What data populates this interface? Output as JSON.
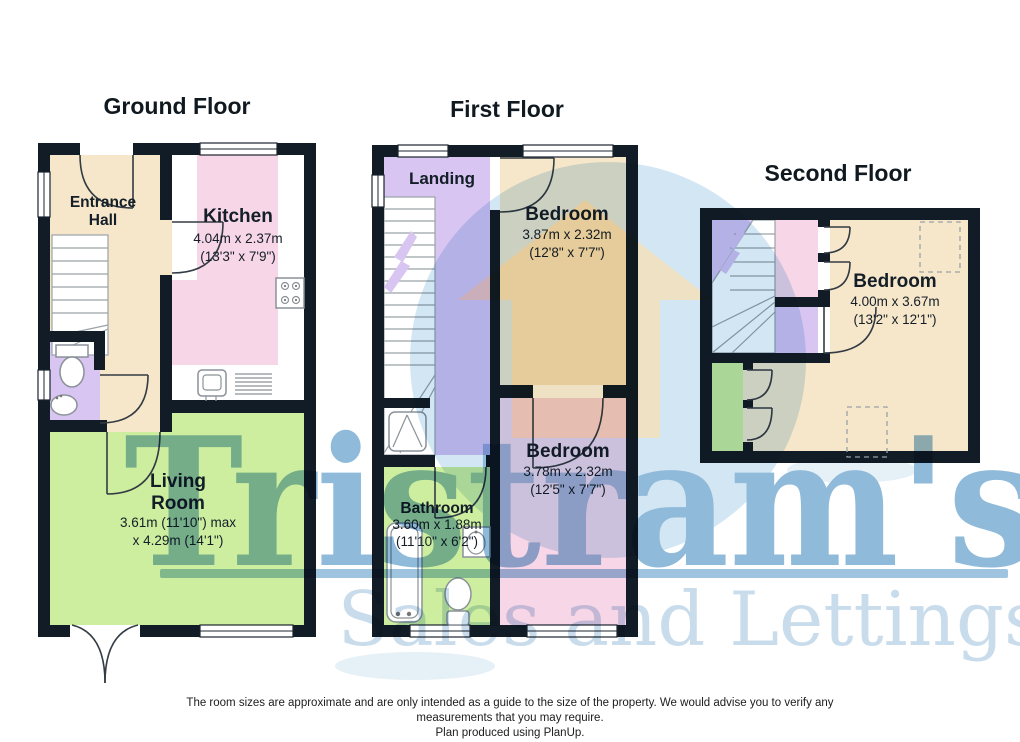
{
  "colors": {
    "wall": "#111c26",
    "cream": "#f7e7ca",
    "pink": "#f7d6e7",
    "green": "#ceee9f",
    "purple": "#d9c5f1",
    "circle": "#cfe4f2",
    "house": "#eeddba",
    "brand": "#84b3d6",
    "tagline": "#c3d9ea",
    "label": "#141e28"
  },
  "floors": {
    "ground": {
      "title": "Ground Floor",
      "entrance_hall": {
        "line1": "Entrance",
        "line2": "Hall"
      },
      "kitchen": {
        "name": "Kitchen",
        "metric": "4.04m x 2.37m",
        "imperial": "(13'3\" x 7'9\")"
      },
      "living_room": {
        "line1": "Living",
        "line2": "Room",
        "metric": "3.61m (11'10\") max",
        "imperial": "x 4.29m (14'1\")"
      }
    },
    "first": {
      "title": "First Floor",
      "landing": {
        "name": "Landing"
      },
      "bedroom_front": {
        "name": "Bedroom",
        "metric": "3.87m x 2.32m",
        "imperial": "(12'8\" x 7'7\")"
      },
      "bedroom_back": {
        "name": "Bedroom",
        "metric": "3.78m x 2.32m",
        "imperial": "(12'5\" x 7'7\")"
      },
      "bathroom": {
        "name": "Bathroom",
        "metric": "3.60m x 1.88m",
        "imperial": "(11'10\" x 6'2\")"
      }
    },
    "second": {
      "title": "Second Floor",
      "bedroom": {
        "name": "Bedroom",
        "metric": "4.00m x 3.67m",
        "imperial": "(13'2\" x 12'1\")"
      }
    }
  },
  "watermark": {
    "brand": "Tristram's",
    "tagline": "Sales and Lettings"
  },
  "footer": {
    "line1": "The room sizes are approximate and are only intended as a guide to the size of the property. We would advise you to verify any",
    "line2": "measurements that you may require.",
    "line3": "Plan produced using PlanUp."
  }
}
